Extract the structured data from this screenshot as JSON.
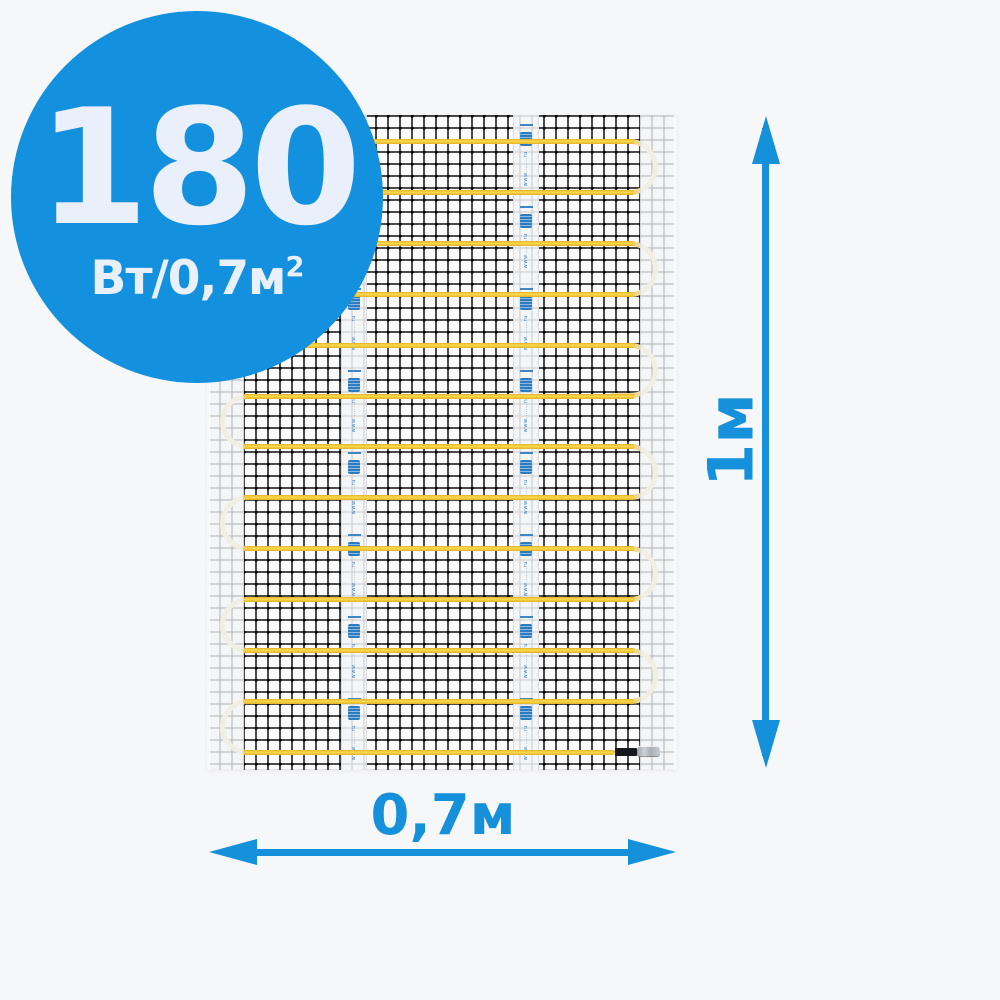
{
  "badge": {
    "value": "180",
    "unit_base": "Вт/0,7м",
    "unit_sup": "2",
    "bg_color": "#1391DE",
    "text_color": "#E9F0FB"
  },
  "dimensions": {
    "vertical_label": "1м",
    "horizontal_label": "0,7м",
    "arrow_color": "#1590DB"
  },
  "mat": {
    "tape_text": "www.......ru",
    "tape_segments_per_strip": 8,
    "tapes_x": [
      134,
      306
    ],
    "cable": {
      "runs": 13,
      "first_y": 24,
      "spacing": 50.9,
      "thickness": 5,
      "x_start": 36,
      "x_end": 428,
      "last_x_end": 408
    },
    "cable_color": "#F6C93B",
    "loop_color": "#EFD795",
    "mesh_color": "#1C1C1E"
  }
}
